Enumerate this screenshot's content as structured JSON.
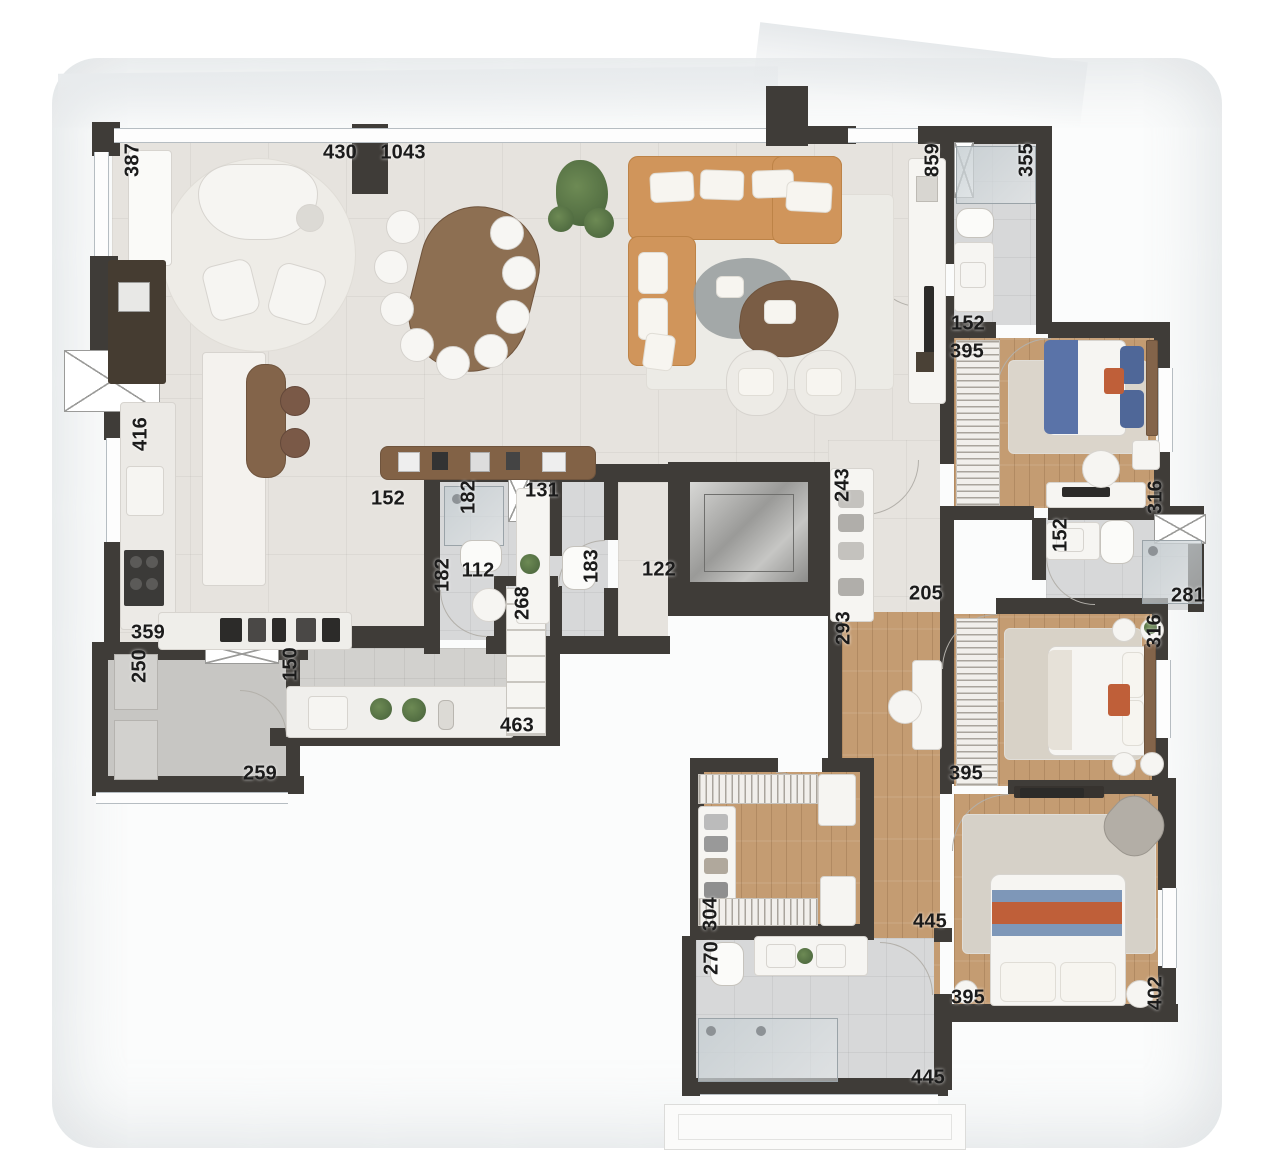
{
  "title": "apartment-floor-plan",
  "colors": {
    "wall": "#3F3C38",
    "sofa": "#D0955B",
    "woodfurn": "#83644A",
    "label": "#1B1B1B",
    "bedBlue": "#5A73A8",
    "accentOrange": "#BF5F39",
    "plantGreen": "#55713F",
    "glassGray": "#9AA3A8"
  },
  "labels": [
    {
      "text": "387",
      "x": 133,
      "y": 160,
      "vertical": true
    },
    {
      "text": "430",
      "x": 340,
      "y": 153,
      "vertical": false
    },
    {
      "text": "1043",
      "x": 403,
      "y": 153,
      "vertical": false
    },
    {
      "text": "859",
      "x": 933,
      "y": 160,
      "vertical": true
    },
    {
      "text": "355",
      "x": 1027,
      "y": 160,
      "vertical": true
    },
    {
      "text": "152",
      "x": 968,
      "y": 324,
      "vertical": false
    },
    {
      "text": "395",
      "x": 967,
      "y": 352,
      "vertical": false
    },
    {
      "text": "316",
      "x": 1156,
      "y": 497,
      "vertical": true
    },
    {
      "text": "152",
      "x": 1061,
      "y": 535,
      "vertical": true
    },
    {
      "text": "281",
      "x": 1188,
      "y": 596,
      "vertical": false
    },
    {
      "text": "416",
      "x": 141,
      "y": 434,
      "vertical": true
    },
    {
      "text": "152",
      "x": 388,
      "y": 499,
      "vertical": false
    },
    {
      "text": "182",
      "x": 469,
      "y": 497,
      "vertical": true
    },
    {
      "text": "131",
      "x": 542,
      "y": 491,
      "vertical": false
    },
    {
      "text": "182",
      "x": 443,
      "y": 575,
      "vertical": true
    },
    {
      "text": "112",
      "x": 478,
      "y": 571,
      "vertical": false
    },
    {
      "text": "183",
      "x": 592,
      "y": 566,
      "vertical": true
    },
    {
      "text": "122",
      "x": 659,
      "y": 570,
      "vertical": false
    },
    {
      "text": "243",
      "x": 843,
      "y": 485,
      "vertical": true
    },
    {
      "text": "268",
      "x": 523,
      "y": 603,
      "vertical": true
    },
    {
      "text": "205",
      "x": 926,
      "y": 594,
      "vertical": false
    },
    {
      "text": "293",
      "x": 844,
      "y": 628,
      "vertical": true
    },
    {
      "text": "316",
      "x": 1155,
      "y": 631,
      "vertical": true
    },
    {
      "text": "395",
      "x": 966,
      "y": 774,
      "vertical": false
    },
    {
      "text": "359",
      "x": 148,
      "y": 633,
      "vertical": false
    },
    {
      "text": "250",
      "x": 140,
      "y": 666,
      "vertical": true
    },
    {
      "text": "150",
      "x": 291,
      "y": 664,
      "vertical": true
    },
    {
      "text": "463",
      "x": 517,
      "y": 726,
      "vertical": false
    },
    {
      "text": "259",
      "x": 260,
      "y": 774,
      "vertical": false
    },
    {
      "text": "304",
      "x": 711,
      "y": 914,
      "vertical": true
    },
    {
      "text": "445",
      "x": 930,
      "y": 922,
      "vertical": false
    },
    {
      "text": "270",
      "x": 712,
      "y": 958,
      "vertical": true
    },
    {
      "text": "395",
      "x": 968,
      "y": 998,
      "vertical": false
    },
    {
      "text": "402",
      "x": 1156,
      "y": 993,
      "vertical": true
    },
    {
      "text": "445",
      "x": 928,
      "y": 1078,
      "vertical": false
    }
  ]
}
